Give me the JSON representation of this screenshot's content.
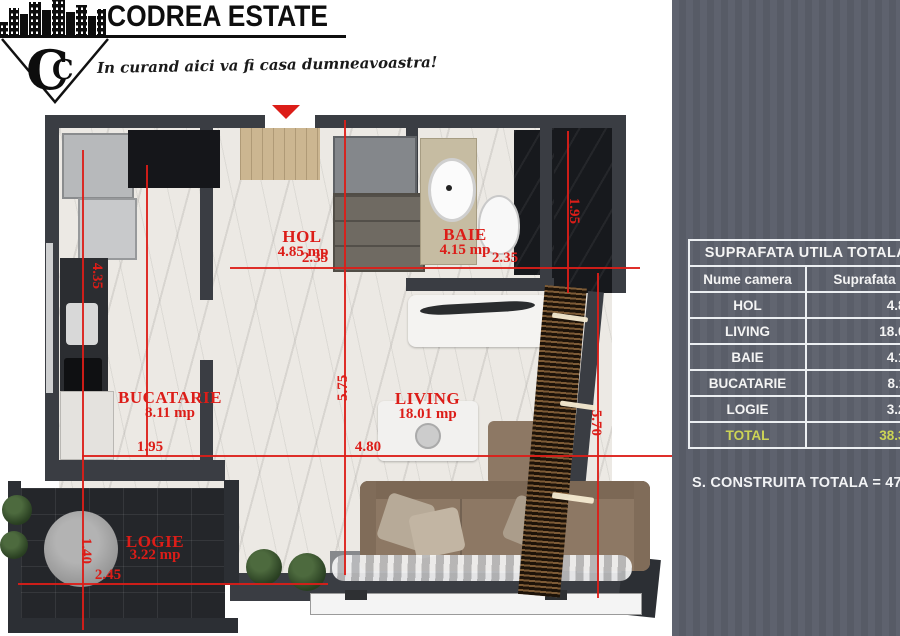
{
  "brand": {
    "name": "CODREA ESTATE",
    "monogram": "C",
    "monogram_inner": "C",
    "tagline": "In curand aici va fi casa dumneavoastra!"
  },
  "floorplan": {
    "accent_color": "#dc1d18",
    "rooms": [
      {
        "name": "HOL",
        "area": "4.85 mp"
      },
      {
        "name": "BAIE",
        "area": "4.15 mp"
      },
      {
        "name": "BUCATARIE",
        "area": "8.11 mp"
      },
      {
        "name": "LIVING",
        "area": "18.01 mp"
      },
      {
        "name": "LOGIE",
        "area": "3.22 mp"
      }
    ],
    "dims": {
      "hol_width": "2.35",
      "baie_width": "2.35",
      "kitchen_width": "1.95",
      "living_width": "4.80",
      "kitchen_height": "4.35",
      "living_height": "5.75",
      "dressing_height": "1.95",
      "terrace_height": "5.70",
      "logie_depth": "1.40",
      "logie_width": "2.45"
    }
  },
  "panel": {
    "bg_color": "#5a5e6a",
    "table": {
      "title": "SUPRAFATA UTILA TOTALA",
      "columns": [
        "Nume camera",
        "Suprafata"
      ],
      "rows": [
        {
          "name": "HOL",
          "value": "4.85"
        },
        {
          "name": "LIVING",
          "value": "18.01"
        },
        {
          "name": "BAIE",
          "value": "4.15"
        },
        {
          "name": "BUCATARIE",
          "value": "8.11"
        },
        {
          "name": "LOGIE",
          "value": "3.22"
        }
      ],
      "total_row": {
        "name": "TOTAL",
        "value": "38.34",
        "color": "#ccd455"
      }
    },
    "footer": "S. CONSTRUITA TOTALA = 47.0"
  }
}
